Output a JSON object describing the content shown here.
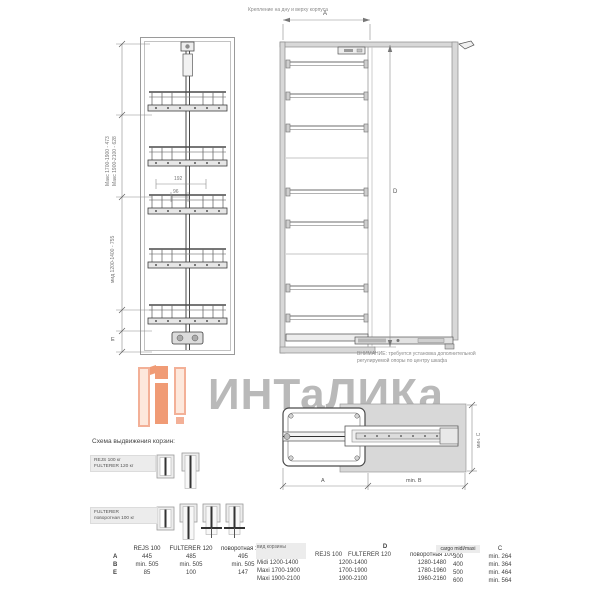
{
  "caption_top": "Крепление на дну и верху корпуса",
  "front_view": {
    "dim_maxi_1": "Макс 1700-1900 - 473",
    "dim_maxi_2": "Макс 1900-2100 - 628",
    "dim_midi": "мид 1200-1400 - 755",
    "dim_e_label": "E",
    "dim_192": "192",
    "dim_96": "96"
  },
  "side_view": {
    "dim_a_label": "A",
    "dim_d_label": "D",
    "note_line1": "ВНИМАНИЕ: требуется установка дополнительной",
    "note_line2": "регулируемой опоры по центру шкафа"
  },
  "top_view": {
    "dim_a_label": "A",
    "dim_b_label": "min. B",
    "dim_c_label": "мин. C"
  },
  "watermark": {
    "text": "ИНТаЛИКа",
    "accent_color": "#ee8a5e",
    "text_color": "#a8a8a8"
  },
  "scheme": {
    "title": "Схема выдвижения корзин:",
    "row1_label_line1": "REJS 100 кг",
    "row1_label_line2": "FULTERER 120 кг",
    "row2_label_line1": "FULTERER",
    "row2_label_line2": "поворотная 100 кг"
  },
  "table_left": {
    "headers": [
      "",
      "REJS 100",
      "FULTERER 120",
      "поворотная 100"
    ],
    "rows": [
      {
        "label": "A",
        "cells": [
          "445",
          "485",
          "495"
        ]
      },
      {
        "label": "B",
        "cells": [
          "min. 505",
          "min. 505",
          "min. 505"
        ]
      },
      {
        "label": "E",
        "cells": [
          "85",
          "100",
          "147"
        ]
      }
    ]
  },
  "table_middle": {
    "col1_header": "вид корзины",
    "d_header": "D",
    "sub_headers": [
      "REJS 100",
      "FULTERER 120",
      "поворотная 100"
    ],
    "rows": [
      {
        "label": "Midi 1200-1400",
        "cells": [
          "1200-1400",
          "1280-1480"
        ]
      },
      {
        "label": "Maxi 1700-1900",
        "cells": [
          "1700-1900",
          "1780-1960"
        ]
      },
      {
        "label": "Maxi 1900-2100",
        "cells": [
          "1900-2100",
          "1960-2160"
        ]
      }
    ]
  },
  "table_right": {
    "col1_header": "cargo midi/maxi",
    "col2_header": "C",
    "rows": [
      {
        "label": "300",
        "value": "min. 264"
      },
      {
        "label": "400",
        "value": "min. 364"
      },
      {
        "label": "500",
        "value": "min. 464"
      },
      {
        "label": "600",
        "value": "min. 564"
      }
    ]
  }
}
